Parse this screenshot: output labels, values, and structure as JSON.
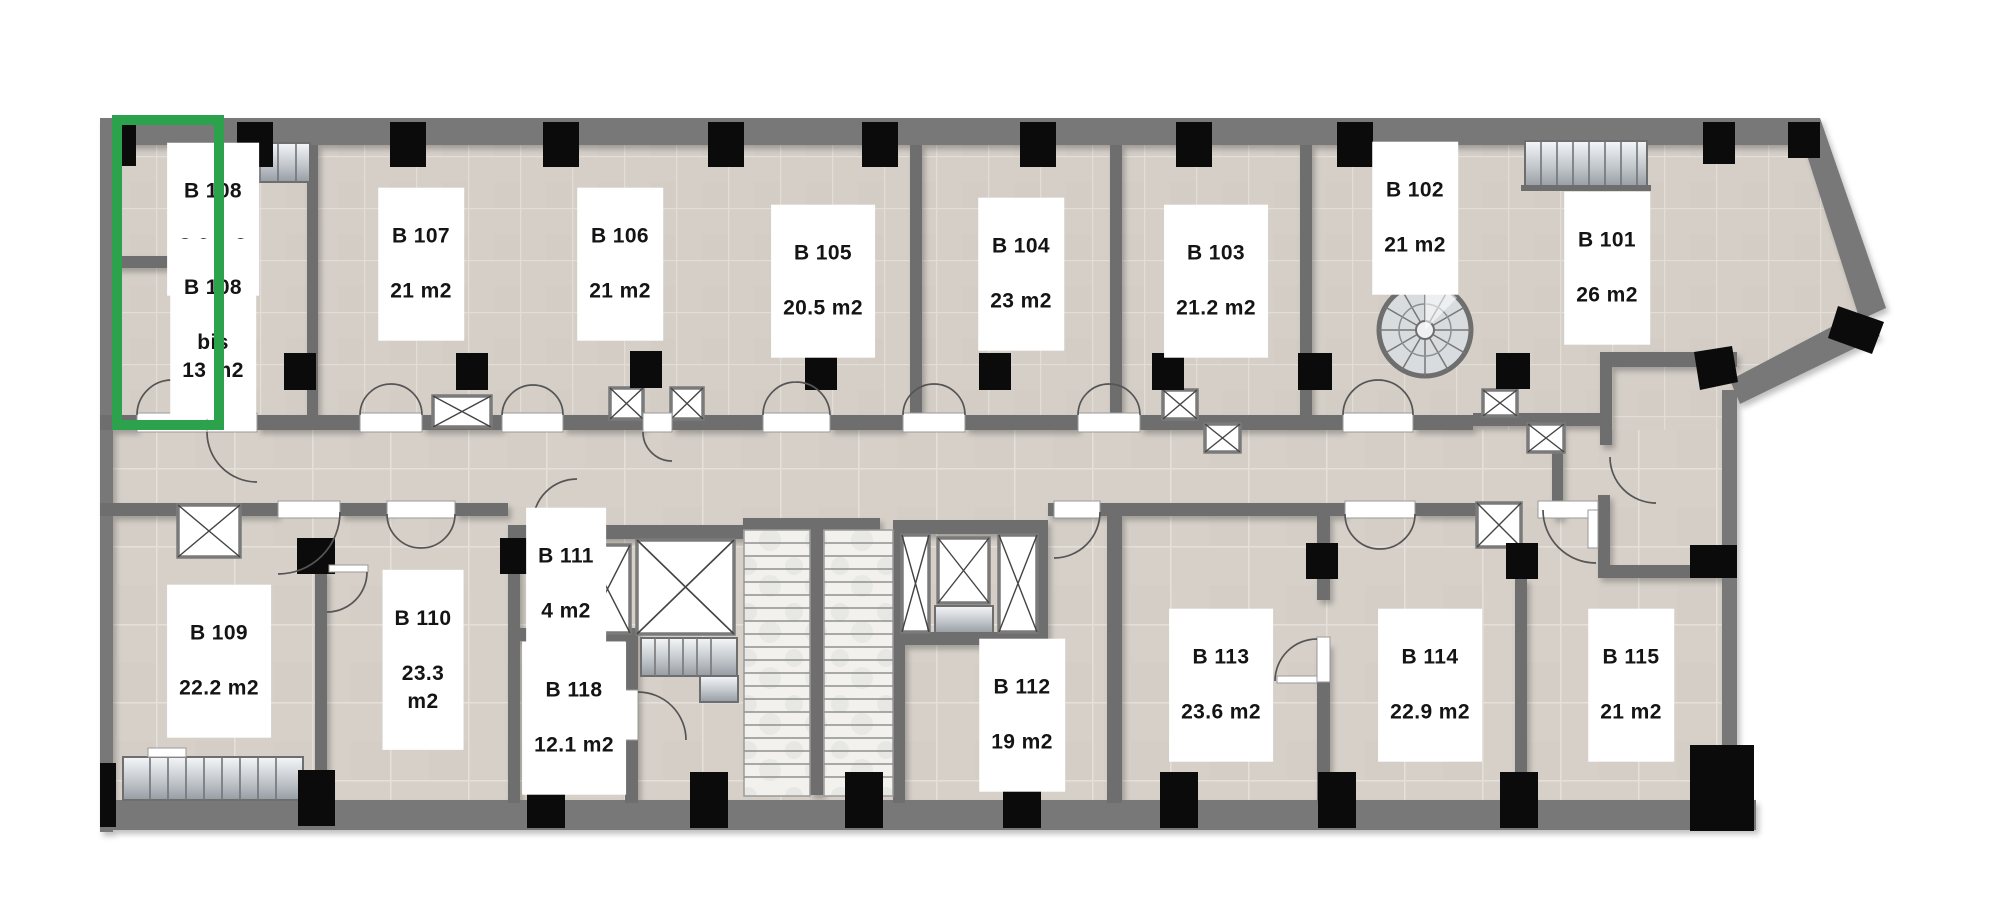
{
  "plan": {
    "selected_unit": "B 108",
    "highlight_color": "#2ca24c",
    "colors": {
      "outer_wall": "#787878",
      "inner_wall": "#6e6e6e",
      "column": "#0b0b0b",
      "floor_tile": "#d5cfc8",
      "tile_grout": "#e2ddd7",
      "shaft_border": "#7a7a7a",
      "stair_marble": "#f2f1ee",
      "label_bg": "#ffffff",
      "label_text": "#141414"
    },
    "icons": {
      "elevator_shaft": "crossed-box",
      "spiral_staircase": "radial-circle",
      "door": "quarter-arc"
    }
  },
  "rooms": [
    {
      "id": "B108",
      "name": "B 108",
      "area": "8.6 m2"
    },
    {
      "id": "B108bis",
      "name": "B 108",
      "area": "bis\n13 m2"
    },
    {
      "id": "B107",
      "name": "B 107",
      "area": "21 m2"
    },
    {
      "id": "B106",
      "name": "B 106",
      "area": "21 m2"
    },
    {
      "id": "B105",
      "name": "B 105",
      "area": "20.5 m2"
    },
    {
      "id": "B104",
      "name": "B 104",
      "area": "23 m2"
    },
    {
      "id": "B103",
      "name": "B 103",
      "area": "21.2 m2"
    },
    {
      "id": "B102",
      "name": "B 102",
      "area": "21 m2"
    },
    {
      "id": "B101",
      "name": "B 101",
      "area": "26 m2"
    },
    {
      "id": "B109",
      "name": "B 109",
      "area": "22.2 m2"
    },
    {
      "id": "B110",
      "name": "B 110",
      "area": "23.3\nm2"
    },
    {
      "id": "B111",
      "name": "B 111",
      "area": "4 m2"
    },
    {
      "id": "B118",
      "name": "B 118",
      "area": "12.1 m2"
    },
    {
      "id": "B112",
      "name": "B 112",
      "area": "19 m2"
    },
    {
      "id": "B113",
      "name": "B 113",
      "area": "23.6 m2"
    },
    {
      "id": "B114",
      "name": "B 114",
      "area": "22.9 m2"
    },
    {
      "id": "B115",
      "name": "B 115",
      "area": "21 m2"
    }
  ]
}
